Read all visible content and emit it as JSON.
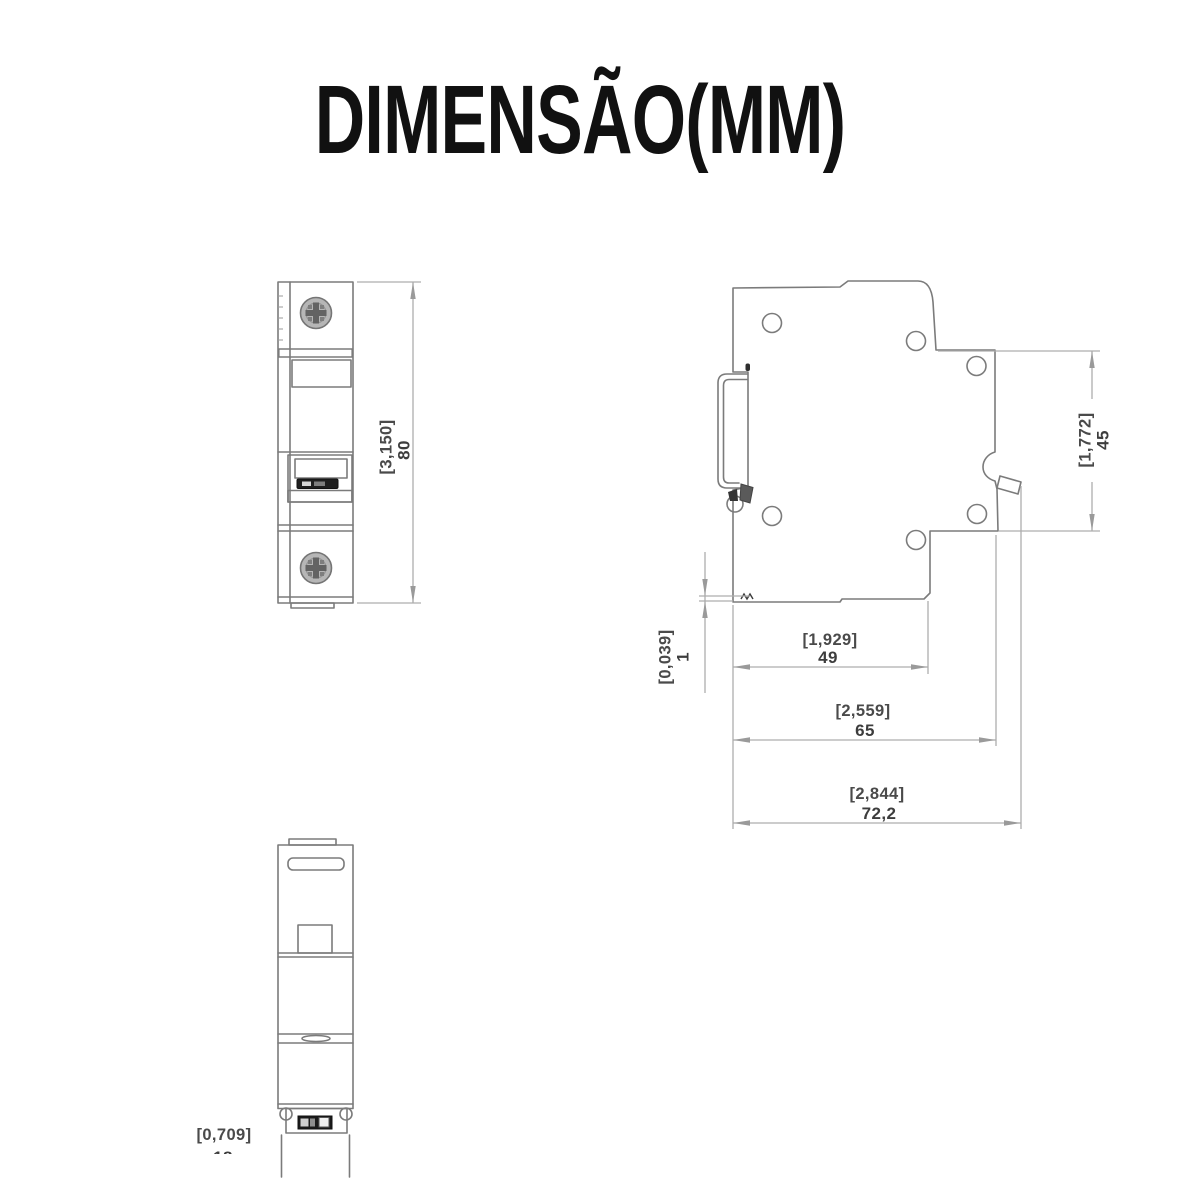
{
  "title": "DIMENSÃO(MM)",
  "drawing": {
    "type": "technical-dimension-drawing",
    "subject": "miniature-circuit-breaker",
    "views": [
      "front-view",
      "side-view",
      "bottom-view"
    ]
  },
  "dimensions": {
    "front_height": {
      "inch": "[3,150]",
      "mm": "80"
    },
    "side_upper_depth": {
      "inch": "[1,772]",
      "mm": "45"
    },
    "side_step": {
      "inch": "[0,039]",
      "mm": "1"
    },
    "side_body_depth": {
      "inch": "[1,929]",
      "mm": "49"
    },
    "side_rail_depth": {
      "inch": "[2,559]",
      "mm": "65"
    },
    "side_total_depth": {
      "inch": "[2,844]",
      "mm": "72,2"
    },
    "bottom_width": {
      "inch": "[0,709]",
      "mm": "18"
    }
  }
}
